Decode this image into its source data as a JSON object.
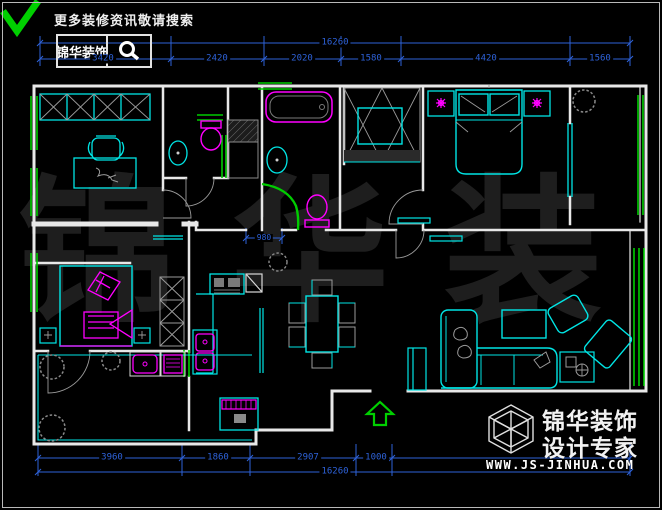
{
  "header": {
    "check_icon": "green-check",
    "search_hint": "更多装修资讯敬请搜索",
    "brand": "锦华装饰",
    "search_icon": "magnifier"
  },
  "watermark": {
    "text": "锦 华 装 饰"
  },
  "dims": {
    "top": {
      "total": "16260",
      "segments": [
        "3420",
        "2420",
        "2020",
        "1580",
        "4420",
        "1560"
      ]
    },
    "bottom": {
      "total": "16260",
      "segments": [
        "3960",
        "1860",
        "2907",
        "1000"
      ]
    },
    "inner": {
      "opening": "980"
    }
  },
  "entry": {
    "arrow_icon": "up-arrow"
  },
  "footer": {
    "logo_icon": "cube-wireframe",
    "brand_line1": "锦华装饰",
    "brand_line2": "设计专家",
    "website": "WWW.JS-JINHUA.COM"
  },
  "colors": {
    "background": "#000000",
    "wall": "#e8e8e8",
    "window_green": "#00cc00",
    "furniture_cyan": "#00e5e5",
    "fixture_magenta": "#ff00ff",
    "dimension_blue": "#2e62d9",
    "plant_gray": "#8a8a8a",
    "watermark_gray": "#1e1e1e",
    "arrow_green": "#00d000"
  }
}
